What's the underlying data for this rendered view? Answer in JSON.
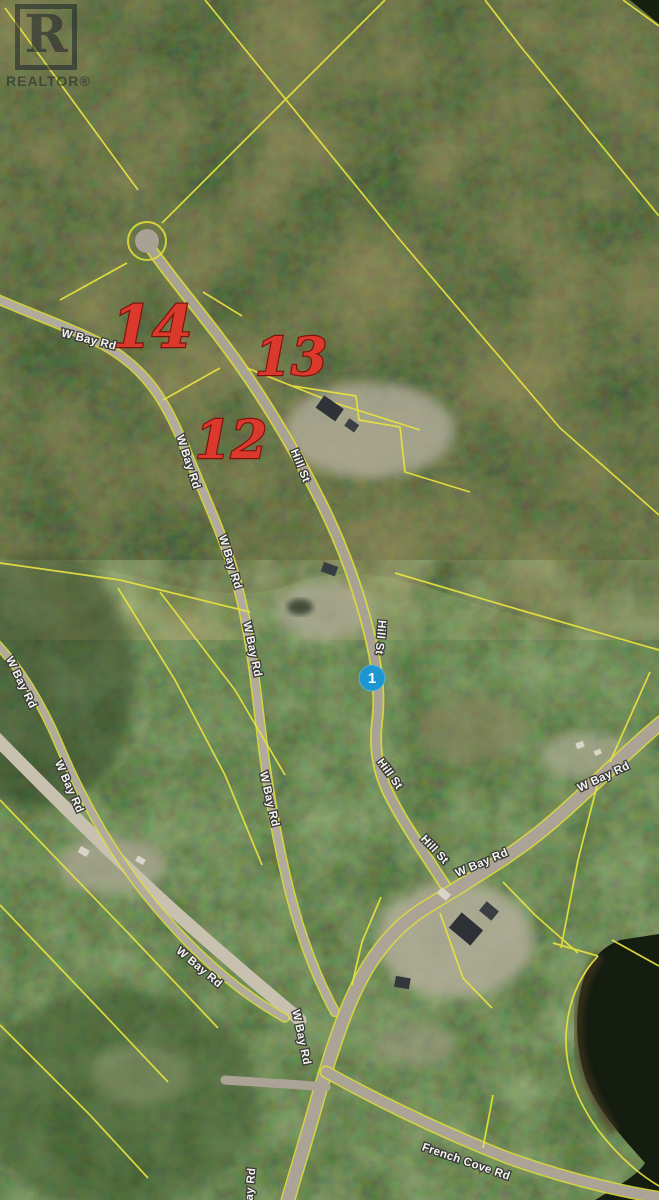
{
  "map": {
    "watermark": {
      "letter": "R",
      "label": "REALTOR®"
    },
    "marker": {
      "label": "1",
      "x": 372,
      "y": 678,
      "color": "#1e96d2"
    },
    "lot_numbers": [
      {
        "text": "14",
        "x": 152,
        "y": 347,
        "size": 58
      },
      {
        "text": "13",
        "x": 291,
        "y": 375,
        "size": 52
      },
      {
        "text": "12",
        "x": 231,
        "y": 458,
        "size": 52
      }
    ],
    "road_labels": [
      {
        "text": "W Bay Rd",
        "x": 88,
        "y": 343,
        "rot": 14
      },
      {
        "text": "W Bay Rd",
        "x": 185,
        "y": 463,
        "rot": 72
      },
      {
        "text": "W Bay Rd",
        "x": 227,
        "y": 563,
        "rot": 73
      },
      {
        "text": "W Bay Rd",
        "x": 249,
        "y": 650,
        "rot": 78
      },
      {
        "text": "W Bay Rd",
        "x": 266,
        "y": 800,
        "rot": 77
      },
      {
        "text": "Hill St",
        "x": 297,
        "y": 467,
        "rot": 68
      },
      {
        "text": "Hill St",
        "x": 377,
        "y": 637,
        "rot": 95
      },
      {
        "text": "Hill St",
        "x": 387,
        "y": 776,
        "rot": 54
      },
      {
        "text": "Hill St",
        "x": 432,
        "y": 852,
        "rot": 47
      },
      {
        "text": "W Bay Rd",
        "x": 483,
        "y": 866,
        "rot": -23
      },
      {
        "text": "W Bay Rd",
        "x": 605,
        "y": 780,
        "rot": -25
      },
      {
        "text": "W Bay Rd",
        "x": 18,
        "y": 684,
        "rot": 64
      },
      {
        "text": "W Bay Rd",
        "x": 66,
        "y": 788,
        "rot": 66
      },
      {
        "text": "W Bay Rd",
        "x": 197,
        "y": 970,
        "rot": 40
      },
      {
        "text": "W Bay Rd",
        "x": 298,
        "y": 1038,
        "rot": 78
      },
      {
        "text": "French Cove Rd",
        "x": 465,
        "y": 1165,
        "rot": 19
      },
      {
        "text": "W Bay Rd",
        "x": 253,
        "y": 1196,
        "rot": -85
      }
    ],
    "colors": {
      "parcel_line": "#e8e33e",
      "lot_number": "#dc392d",
      "road": "#aba496",
      "gravel_road": "#c8c1af",
      "water": "#141d10",
      "forest_top": "#33491f",
      "forest_bottom": "#47672f",
      "label_text": "#f4f4f1",
      "marker_blue": "#1e96d2"
    }
  }
}
